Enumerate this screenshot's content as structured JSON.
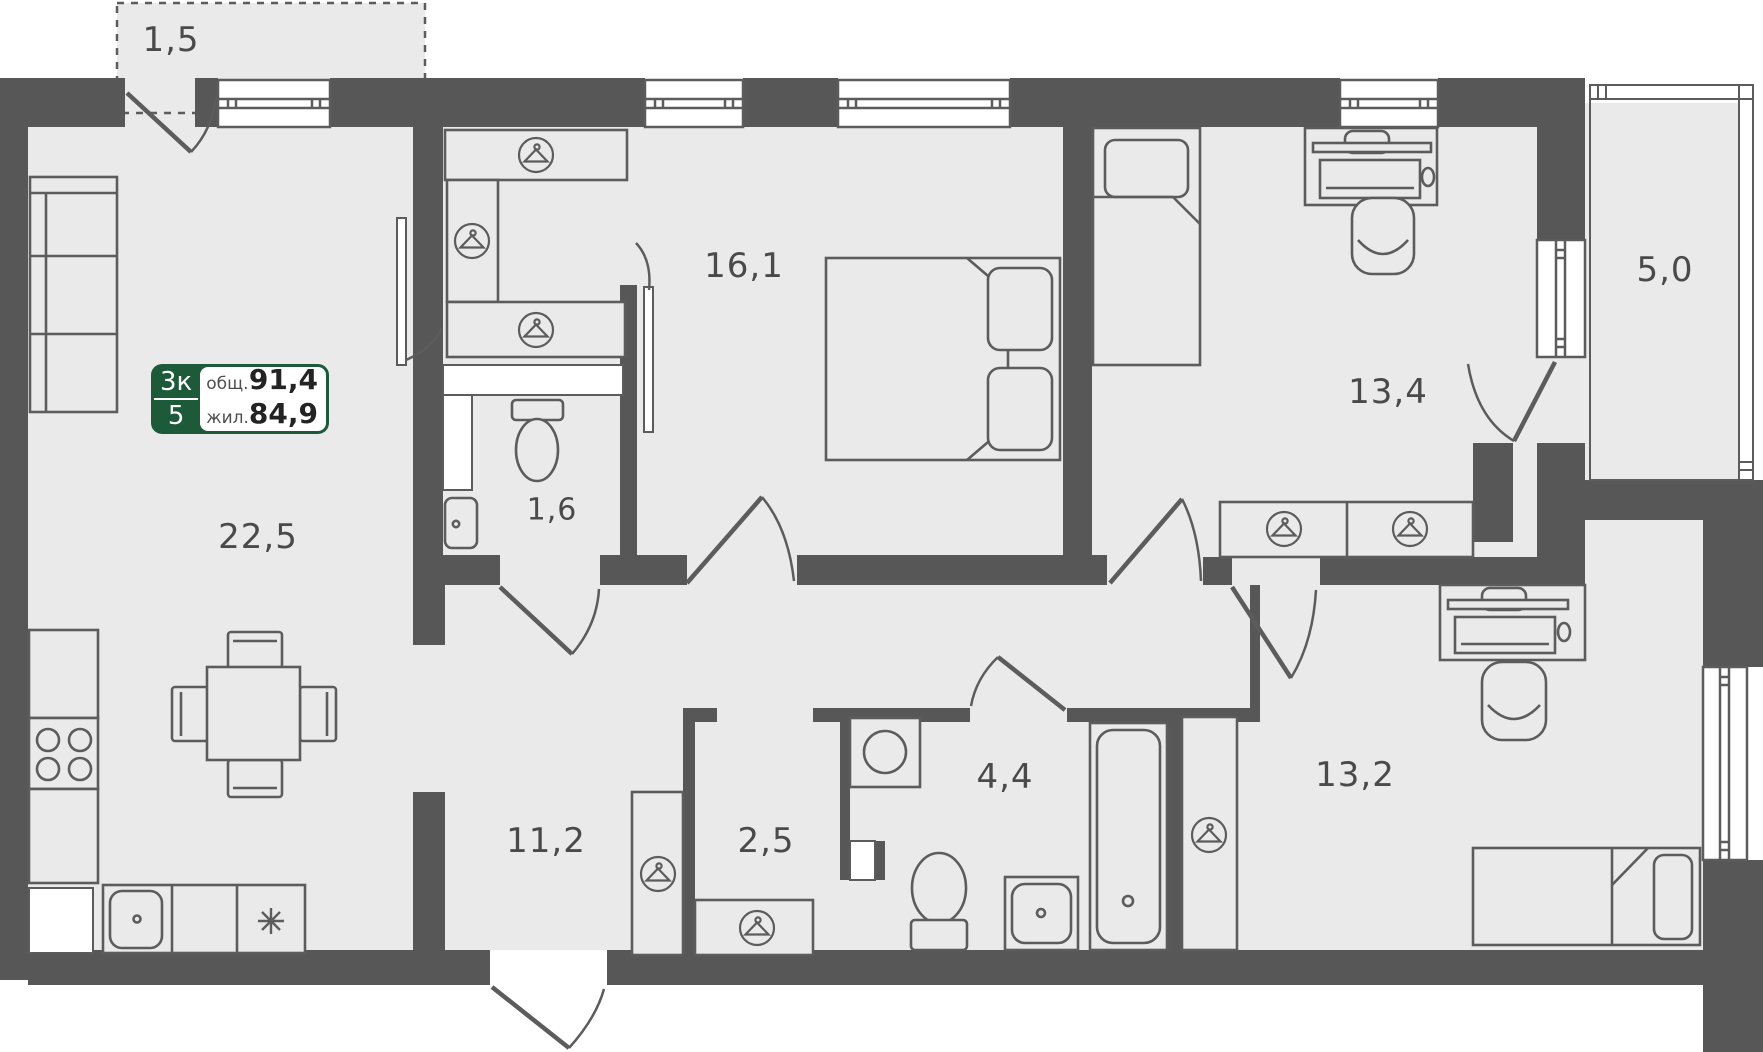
{
  "plan_card": {
    "rooms_count": "3к",
    "floor": "5",
    "total_label": "общ.",
    "total_value": "91,4",
    "living_label": "жил.",
    "living_value": "84,9"
  },
  "room_areas": {
    "balcony_small": "1,5",
    "kitchen_living": "22,5",
    "bedroom": "16,1",
    "wc": "1,6",
    "hallway": "11,2",
    "wardrobe_room": "2,5",
    "bathroom": "4,4",
    "kids_room": "13,4",
    "loggia": "5,0",
    "bedroom_second": "13,2"
  },
  "icons": {
    "wardrobe": "hanger-icon",
    "fridge": "snowflake-icon",
    "stove": "four-burners-icon"
  },
  "colors": {
    "wall": "#575757",
    "floor": "#eaeaea",
    "line": "#5c5c5c",
    "badge_green": "#1d5a3a",
    "label_text": "#4a4a4a"
  }
}
